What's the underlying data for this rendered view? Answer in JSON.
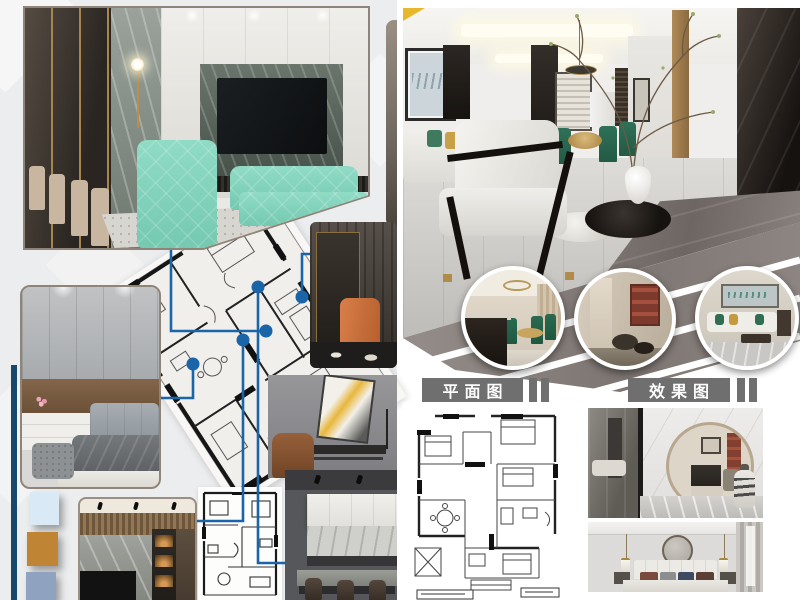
{
  "labels": {
    "plan_section": "平面图",
    "render_section": "效果图"
  },
  "palette": {
    "connector_blue": "#1a64a8",
    "label_gray": "#6f6f6f",
    "navy_bar": "#17496d",
    "teal_sofa": "#85d6bf",
    "accent_yellow": "#e8b82c",
    "orange_chair": "#cf7340",
    "deck_gray": "#8d8683",
    "swatches": [
      "#d9e9f5",
      "#bf8434",
      "#8fa2bf"
    ]
  }
}
